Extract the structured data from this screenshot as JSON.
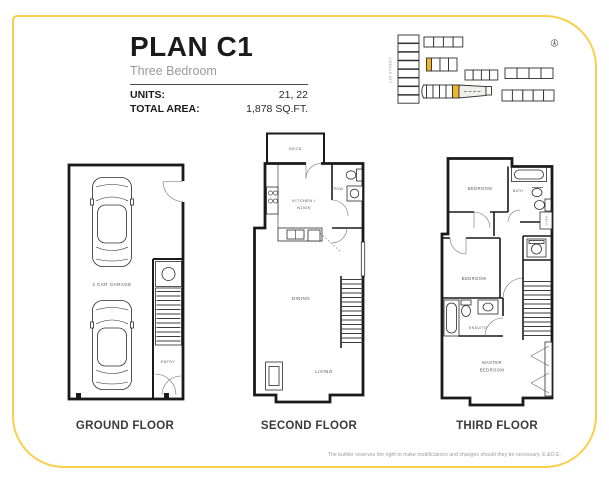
{
  "page": {
    "border_color": "#fbcf4b",
    "disclaimer": "The builder reserves the right to make modifications and changes should they be necessary. E.&O.E."
  },
  "header": {
    "title": "PLAN C1",
    "subtitle": "Three Bedroom",
    "specs": [
      {
        "label": "UNITS:",
        "value": "21, 22"
      },
      {
        "label": "TOTAL AREA:",
        "value": "1,878 SQ.FT."
      }
    ]
  },
  "site_map": {
    "street_label": "138 STREET",
    "highlight_color": "#f0b62a",
    "compass_icon": "north-compass"
  },
  "floors": [
    {
      "name": "GROUND FLOOR",
      "labels": {
        "garage": "2 CAR GARAGE",
        "entry": "ENTRY"
      }
    },
    {
      "name": "SECOND FLOOR",
      "labels": {
        "deck": "DECK",
        "kitchen_line1": "KITCHEN /",
        "kitchen_line2": "NOOK",
        "powder": "POW.",
        "dining": "DINING",
        "living": "LIVING"
      }
    },
    {
      "name": "THIRD FLOOR",
      "labels": {
        "bedroom_top": "BEDROOM",
        "bath": "BATH",
        "linen": "LINEN",
        "bedroom_mid": "BEDROOM",
        "ensuite": "ENSUITE",
        "master_line1": "MASTER",
        "master_line2": "BEDROOM"
      }
    }
  ]
}
